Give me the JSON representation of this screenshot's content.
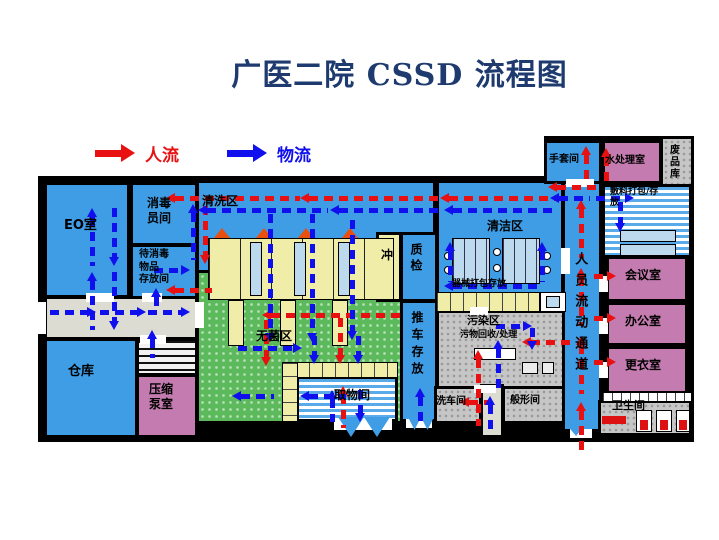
{
  "title": "广医二院 CSSD 流程图",
  "legend": {
    "people_label": "人流",
    "material_label": "物流"
  },
  "colors": {
    "red": "#e81010",
    "blue_arrow": "#1010ee",
    "title": "#1e3a6e",
    "blue": "#3f9de6",
    "green": "#5cba5c",
    "yellow": "#f0eda8",
    "pink": "#c47cb0",
    "gray": "#c6c6c6",
    "lgray": "#dcdcd2",
    "white": "#ffffff",
    "table_blue": "#bcd9ee",
    "wall": "#000000"
  },
  "rooms": [
    {
      "id": "eo",
      "x": 44,
      "y": 182,
      "w": 86,
      "h": 116,
      "f": "blue"
    },
    {
      "id": "xiaodu-yuanjian",
      "x": 130,
      "y": 182,
      "w": 68,
      "h": 64,
      "f": "blue"
    },
    {
      "id": "daixiaodu-cunfang",
      "x": 130,
      "y": 244,
      "w": 68,
      "h": 56,
      "f": "blue"
    },
    {
      "id": "corridor-left",
      "x": 44,
      "y": 296,
      "w": 154,
      "h": 44,
      "f": "lgray"
    },
    {
      "id": "cangku",
      "x": 44,
      "y": 338,
      "w": 94,
      "h": 100,
      "f": "blue"
    },
    {
      "id": "stairs",
      "x": 136,
      "y": 338,
      "w": 62,
      "h": 38,
      "f": "white",
      "p": "hatch"
    },
    {
      "id": "yasuo-bengshi",
      "x": 136,
      "y": 374,
      "w": 62,
      "h": 64,
      "f": "pink"
    },
    {
      "id": "qingxiqu",
      "x": 196,
      "y": 180,
      "w": 240,
      "h": 124,
      "f": "blue"
    },
    {
      "id": "wujunqu",
      "x": 196,
      "y": 270,
      "w": 240,
      "h": 154,
      "f": "green",
      "p": "dots"
    },
    {
      "id": "chong",
      "x": 376,
      "y": 232,
      "w": 26,
      "h": 70,
      "f": "yellow"
    },
    {
      "id": "zhijian",
      "x": 400,
      "y": 232,
      "w": 38,
      "h": 70,
      "f": "blue"
    },
    {
      "id": "tuiche-cunfang",
      "x": 400,
      "y": 300,
      "w": 38,
      "h": 122,
      "f": "blue"
    },
    {
      "id": "quwujian",
      "x": 296,
      "y": 376,
      "w": 102,
      "h": 46,
      "f": "white",
      "p": "stripes"
    },
    {
      "id": "qingjiequ",
      "x": 436,
      "y": 180,
      "w": 128,
      "h": 122,
      "f": "blue"
    },
    {
      "id": "wuranqu",
      "x": 436,
      "y": 310,
      "w": 130,
      "h": 80,
      "f": "gray",
      "p": "gdots"
    },
    {
      "id": "xichejian",
      "x": 434,
      "y": 386,
      "w": 48,
      "h": 38,
      "f": "gray",
      "p": "gdots"
    },
    {
      "id": "bottom-corridor",
      "x": 480,
      "y": 384,
      "w": 24,
      "h": 54,
      "f": "lgray"
    },
    {
      "id": "banxingjian",
      "x": 502,
      "y": 386,
      "w": 64,
      "h": 38,
      "f": "gray",
      "p": "gdots"
    },
    {
      "id": "renyuan-corridor",
      "x": 562,
      "y": 180,
      "w": 40,
      "h": 252,
      "f": "blue"
    },
    {
      "id": "shoutaojian",
      "x": 544,
      "y": 140,
      "w": 58,
      "h": 44,
      "f": "blue"
    },
    {
      "id": "shuichulishi",
      "x": 602,
      "y": 140,
      "w": 60,
      "h": 44,
      "f": "pink"
    },
    {
      "id": "feipinku",
      "x": 660,
      "y": 136,
      "w": 34,
      "h": 62,
      "f": "gray",
      "p": "gdots"
    },
    {
      "id": "fuliao-dabao",
      "x": 602,
      "y": 184,
      "w": 90,
      "h": 74,
      "f": "white",
      "p": "stripes"
    },
    {
      "id": "huiyishi",
      "x": 606,
      "y": 256,
      "w": 82,
      "h": 46,
      "f": "pink"
    },
    {
      "id": "bangongshi",
      "x": 606,
      "y": 302,
      "w": 82,
      "h": 44,
      "f": "pink"
    },
    {
      "id": "gengyishi",
      "x": 606,
      "y": 346,
      "w": 82,
      "h": 48,
      "f": "pink"
    },
    {
      "id": "weishengjian",
      "x": 598,
      "y": 400,
      "w": 94,
      "h": 36,
      "f": "gray",
      "p": "gdots"
    }
  ],
  "labels": [
    {
      "id": "eo",
      "t": "EO室",
      "x": 64,
      "y": 218,
      "fs": 13
    },
    {
      "id": "xiaodu-yuanjian",
      "t": "消毒\n员间",
      "x": 147,
      "y": 196,
      "fs": 12
    },
    {
      "id": "daixiaodu",
      "t": "待消毒\n物品\n存放间",
      "x": 139,
      "y": 249,
      "fs": 10
    },
    {
      "id": "cangku",
      "t": "仓库",
      "x": 68,
      "y": 364,
      "fs": 13
    },
    {
      "id": "yasuo",
      "t": "压缩\n泵室",
      "x": 149,
      "y": 382,
      "fs": 12
    },
    {
      "id": "qingxiqu",
      "t": "清洗区",
      "x": 202,
      "y": 194,
      "fs": 12
    },
    {
      "id": "wujunqu",
      "t": "无菌区",
      "x": 256,
      "y": 329,
      "fs": 12
    },
    {
      "id": "chong",
      "t": "冲",
      "x": 381,
      "y": 248,
      "fs": 12
    },
    {
      "id": "zhijian",
      "t": "质检",
      "x": 408,
      "y": 243,
      "fs": 12,
      "v": 1,
      "ls": 4
    },
    {
      "id": "tuiche",
      "t": "推车存放",
      "x": 409,
      "y": 311,
      "fs": 12,
      "v": 1,
      "ls": 5
    },
    {
      "id": "quwujian",
      "t": "取物间",
      "x": 334,
      "y": 388,
      "fs": 12
    },
    {
      "id": "qingjiequ",
      "t": "清洁区",
      "x": 487,
      "y": 219,
      "fs": 12
    },
    {
      "id": "qixie",
      "t": "器械打包存放",
      "x": 452,
      "y": 279,
      "fs": 9
    },
    {
      "id": "wuranqu",
      "t": "污染区",
      "x": 467,
      "y": 314,
      "fs": 11
    },
    {
      "id": "wuwu",
      "t": "污物回收/处理",
      "x": 460,
      "y": 330,
      "fs": 9
    },
    {
      "id": "xichejian",
      "t": "洗车间",
      "x": 436,
      "y": 396,
      "fs": 10
    },
    {
      "id": "banxingjian",
      "t": "般形间",
      "x": 510,
      "y": 395,
      "fs": 10
    },
    {
      "id": "renyuan",
      "t": "人员流动通道",
      "x": 571,
      "y": 252,
      "fs": 13,
      "v": 1,
      "ls": 8
    },
    {
      "id": "shoutao",
      "t": "手套间",
      "x": 549,
      "y": 154,
      "fs": 10
    },
    {
      "id": "shuichuli",
      "t": "水处理室",
      "x": 605,
      "y": 155,
      "fs": 10
    },
    {
      "id": "feipinku",
      "t": "废品库",
      "x": 666,
      "y": 144,
      "fs": 10,
      "v": 1,
      "ls": 2
    },
    {
      "id": "fuliao",
      "t": "敷料打包/存\n放",
      "x": 610,
      "y": 187,
      "fs": 9
    },
    {
      "id": "huiyishi",
      "t": "会议室",
      "x": 625,
      "y": 268,
      "fs": 12
    },
    {
      "id": "bangongshi",
      "t": "办公室",
      "x": 625,
      "y": 314,
      "fs": 12
    },
    {
      "id": "gengyishi",
      "t": "更衣室",
      "x": 625,
      "y": 358,
      "fs": 12
    },
    {
      "id": "weishengjian",
      "t": "卫生间",
      "x": 612,
      "y": 399,
      "fs": 11
    }
  ],
  "fixtures": [
    {
      "t": "rect",
      "x": 208,
      "y": 238,
      "w": 186,
      "h": 62,
      "f": "yellow",
      "b": 1,
      "p": "cells30"
    },
    {
      "t": "rect",
      "x": 250,
      "y": 242,
      "w": 12,
      "h": 54,
      "f": "table_blue",
      "b": 1
    },
    {
      "t": "rect",
      "x": 294,
      "y": 242,
      "w": 12,
      "h": 54,
      "f": "table_blue",
      "b": 1
    },
    {
      "t": "rect",
      "x": 338,
      "y": 242,
      "w": 12,
      "h": 54,
      "f": "table_blue",
      "b": 1
    },
    {
      "t": "tri",
      "dir": "u",
      "x": 214,
      "y": 228,
      "w": 16,
      "h": 10,
      "f": "#e8500f"
    },
    {
      "t": "tri",
      "dir": "u",
      "x": 256,
      "y": 228,
      "w": 16,
      "h": 10,
      "f": "#e8500f"
    },
    {
      "t": "tri",
      "dir": "u",
      "x": 298,
      "y": 228,
      "w": 16,
      "h": 10,
      "f": "#e8500f"
    },
    {
      "t": "tri",
      "dir": "u",
      "x": 342,
      "y": 228,
      "w": 16,
      "h": 10,
      "f": "#e8500f"
    },
    {
      "t": "rect",
      "x": 228,
      "y": 300,
      "w": 16,
      "h": 46,
      "f": "yellow",
      "b": 1
    },
    {
      "t": "rect",
      "x": 280,
      "y": 300,
      "w": 16,
      "h": 46,
      "f": "yellow",
      "b": 1
    },
    {
      "t": "rect",
      "x": 332,
      "y": 300,
      "w": 16,
      "h": 46,
      "f": "yellow",
      "b": 1
    },
    {
      "t": "rect",
      "x": 282,
      "y": 362,
      "w": 116,
      "h": 16,
      "f": "yellow",
      "b": 1,
      "p": "cells12"
    },
    {
      "t": "rect",
      "x": 282,
      "y": 362,
      "w": 16,
      "h": 60,
      "f": "yellow",
      "b": 1,
      "p": "cellsH"
    },
    {
      "t": "rect",
      "x": 452,
      "y": 238,
      "w": 38,
      "h": 46,
      "f": "table_blue",
      "b": 1,
      "p": "cells10"
    },
    {
      "t": "rect",
      "x": 502,
      "y": 238,
      "w": 38,
      "h": 46,
      "f": "table_blue",
      "b": 1,
      "p": "cells10"
    },
    {
      "t": "circ",
      "x": 444,
      "y": 252,
      "w": 8,
      "h": 8
    },
    {
      "t": "circ",
      "x": 444,
      "y": 266,
      "w": 8,
      "h": 8
    },
    {
      "t": "circ",
      "x": 493,
      "y": 248,
      "w": 8,
      "h": 8
    },
    {
      "t": "circ",
      "x": 493,
      "y": 264,
      "w": 8,
      "h": 8
    },
    {
      "t": "circ",
      "x": 543,
      "y": 252,
      "w": 8,
      "h": 8
    },
    {
      "t": "circ",
      "x": 543,
      "y": 266,
      "w": 8,
      "h": 8
    },
    {
      "t": "rect",
      "x": 436,
      "y": 292,
      "w": 104,
      "h": 20,
      "f": "yellow",
      "b": 1,
      "p": "cells12"
    },
    {
      "t": "rect",
      "x": 540,
      "y": 292,
      "w": 26,
      "h": 20,
      "f": "white",
      "b": 1
    },
    {
      "t": "rect",
      "x": 546,
      "y": 296,
      "w": 14,
      "h": 12,
      "f": "table_blue",
      "b": 1
    },
    {
      "t": "rect",
      "x": 474,
      "y": 348,
      "w": 42,
      "h": 12,
      "f": "white",
      "b": 1
    },
    {
      "t": "rect",
      "x": 522,
      "y": 362,
      "w": 16,
      "h": 12,
      "f": "#ececec",
      "b": 1
    },
    {
      "t": "rect",
      "x": 542,
      "y": 362,
      "w": 12,
      "h": 12,
      "f": "#ececec",
      "b": 1
    },
    {
      "t": "rect",
      "x": 620,
      "y": 230,
      "w": 56,
      "h": 12,
      "f": "table_blue",
      "b": 1
    },
    {
      "t": "rect",
      "x": 620,
      "y": 244,
      "w": 56,
      "h": 12,
      "f": "table_blue",
      "b": 1
    },
    {
      "t": "rect",
      "x": 602,
      "y": 392,
      "w": 90,
      "h": 10,
      "f": "white",
      "b": 1,
      "p": "cells8"
    },
    {
      "t": "rect",
      "x": 636,
      "y": 410,
      "w": 16,
      "h": 22,
      "f": "white",
      "b": 1
    },
    {
      "t": "rect",
      "x": 656,
      "y": 410,
      "w": 16,
      "h": 22,
      "f": "white",
      "b": 1
    },
    {
      "t": "rect",
      "x": 676,
      "y": 410,
      "w": 14,
      "h": 22,
      "f": "white",
      "b": 1
    },
    {
      "t": "rect",
      "x": 640,
      "y": 420,
      "w": 8,
      "h": 10,
      "f": "#dd1111"
    },
    {
      "t": "rect",
      "x": 660,
      "y": 420,
      "w": 8,
      "h": 10,
      "f": "#dd1111"
    },
    {
      "t": "rect",
      "x": 679,
      "y": 420,
      "w": 8,
      "h": 10,
      "f": "#dd1111"
    },
    {
      "t": "rect",
      "x": 602,
      "y": 416,
      "w": 24,
      "h": 8,
      "f": "#dd1111"
    },
    {
      "t": "rect",
      "x": 86,
      "y": 293,
      "w": 28,
      "h": 9,
      "f": "white"
    },
    {
      "t": "rect",
      "x": 142,
      "y": 293,
      "w": 20,
      "h": 9,
      "f": "white"
    },
    {
      "t": "rect",
      "x": 140,
      "y": 335,
      "w": 26,
      "h": 9,
      "f": "white"
    },
    {
      "t": "rect",
      "x": 195,
      "y": 302,
      "w": 9,
      "h": 26,
      "f": "white"
    },
    {
      "t": "rect",
      "x": 334,
      "y": 419,
      "w": 58,
      "h": 11,
      "f": "white"
    },
    {
      "t": "rect",
      "x": 406,
      "y": 419,
      "w": 26,
      "h": 9,
      "f": "white"
    },
    {
      "t": "rect",
      "x": 474,
      "y": 385,
      "w": 22,
      "h": 8,
      "f": "white"
    },
    {
      "t": "rect",
      "x": 561,
      "y": 248,
      "w": 9,
      "h": 26,
      "f": "white"
    },
    {
      "t": "rect",
      "x": 599,
      "y": 276,
      "w": 9,
      "h": 16,
      "f": "white"
    },
    {
      "t": "rect",
      "x": 599,
      "y": 318,
      "w": 9,
      "h": 16,
      "f": "white"
    },
    {
      "t": "rect",
      "x": 599,
      "y": 362,
      "w": 9,
      "h": 16,
      "f": "white"
    },
    {
      "t": "rect",
      "x": 566,
      "y": 179,
      "w": 28,
      "h": 8,
      "f": "white"
    },
    {
      "t": "rect",
      "x": 470,
      "y": 307,
      "w": 18,
      "h": 8,
      "f": "white"
    },
    {
      "t": "rect",
      "x": 38,
      "y": 302,
      "w": 8,
      "h": 32,
      "f": "white"
    },
    {
      "t": "rect",
      "x": 570,
      "y": 429,
      "w": 22,
      "h": 9,
      "f": "white"
    },
    {
      "t": "tri",
      "dir": "d",
      "x": 338,
      "y": 417,
      "w": 26,
      "h": 20,
      "f": "blue"
    },
    {
      "t": "tri",
      "dir": "d",
      "x": 364,
      "y": 417,
      "w": 26,
      "h": 20,
      "f": "blue"
    },
    {
      "t": "tri",
      "dir": "d",
      "x": 408,
      "y": 417,
      "w": 13,
      "h": 13,
      "f": "blue"
    },
    {
      "t": "tri",
      "dir": "d",
      "x": 421,
      "y": 417,
      "w": 13,
      "h": 13,
      "f": "blue"
    },
    {
      "t": "tri",
      "dir": "d",
      "x": 566,
      "y": 424,
      "w": 20,
      "h": 12,
      "f": "blue"
    }
  ],
  "arrows": [
    {
      "c": "r",
      "d": "l",
      "x": 166,
      "y": 196,
      "l": 134
    },
    {
      "c": "r",
      "d": "l",
      "x": 300,
      "y": 196,
      "l": 140
    },
    {
      "c": "r",
      "d": "l",
      "x": 440,
      "y": 196,
      "l": 118
    },
    {
      "c": "r",
      "d": "l",
      "x": 548,
      "y": 185,
      "l": 50
    },
    {
      "c": "r",
      "d": "u",
      "x": 584,
      "y": 146,
      "l": 38
    },
    {
      "c": "r",
      "d": "u",
      "x": 604,
      "y": 148,
      "l": 34
    },
    {
      "c": "r",
      "d": "d",
      "x": 203,
      "y": 206,
      "l": 58
    },
    {
      "c": "r",
      "d": "l",
      "x": 166,
      "y": 288,
      "l": 46
    },
    {
      "c": "r",
      "d": "u",
      "x": 579,
      "y": 200,
      "l": 58
    },
    {
      "c": "r",
      "d": "u",
      "x": 579,
      "y": 268,
      "l": 58
    },
    {
      "c": "r",
      "d": "u",
      "x": 579,
      "y": 336,
      "l": 58
    },
    {
      "c": "r",
      "d": "u",
      "x": 579,
      "y": 402,
      "l": 52
    },
    {
      "c": "r",
      "d": "r",
      "x": 594,
      "y": 274,
      "l": 22
    },
    {
      "c": "r",
      "d": "r",
      "x": 594,
      "y": 316,
      "l": 22
    },
    {
      "c": "r",
      "d": "r",
      "x": 594,
      "y": 360,
      "l": 22
    },
    {
      "c": "r",
      "d": "l",
      "x": 522,
      "y": 340,
      "l": 48
    },
    {
      "c": "r",
      "d": "u",
      "x": 476,
      "y": 350,
      "l": 76
    },
    {
      "c": "r",
      "d": "l",
      "x": 460,
      "y": 400,
      "l": 28
    },
    {
      "c": "r",
      "d": "l",
      "x": 262,
      "y": 313,
      "l": 138
    },
    {
      "c": "r",
      "d": "d",
      "x": 338,
      "y": 318,
      "l": 46
    },
    {
      "c": "r",
      "d": "d",
      "x": 264,
      "y": 320,
      "l": 46
    },
    {
      "c": "r",
      "d": "u",
      "x": 341,
      "y": 386,
      "l": 42
    },
    {
      "c": "b",
      "d": "l",
      "x": 198,
      "y": 208,
      "l": 130
    },
    {
      "c": "b",
      "d": "l",
      "x": 330,
      "y": 208,
      "l": 112
    },
    {
      "c": "b",
      "d": "l",
      "x": 444,
      "y": 208,
      "l": 112
    },
    {
      "c": "b",
      "d": "r",
      "x": 596,
      "y": 196,
      "l": 38
    },
    {
      "c": "b",
      "d": "d",
      "x": 618,
      "y": 202,
      "l": 30
    },
    {
      "c": "b",
      "d": "u",
      "x": 191,
      "y": 204,
      "l": 56
    },
    {
      "c": "b",
      "d": "u",
      "x": 90,
      "y": 208,
      "l": 58
    },
    {
      "c": "b",
      "d": "u",
      "x": 90,
      "y": 272,
      "l": 58
    },
    {
      "c": "b",
      "d": "d",
      "x": 112,
      "y": 208,
      "l": 58
    },
    {
      "c": "b",
      "d": "d",
      "x": 112,
      "y": 272,
      "l": 58
    },
    {
      "c": "b",
      "d": "r",
      "x": 154,
      "y": 268,
      "l": 36
    },
    {
      "c": "b",
      "d": "r",
      "x": 50,
      "y": 310,
      "l": 46
    },
    {
      "c": "b",
      "d": "r",
      "x": 100,
      "y": 310,
      "l": 46
    },
    {
      "c": "b",
      "d": "r",
      "x": 148,
      "y": 310,
      "l": 42
    },
    {
      "c": "b",
      "d": "u",
      "x": 154,
      "y": 288,
      "l": 24
    },
    {
      "c": "b",
      "d": "u",
      "x": 150,
      "y": 330,
      "l": 28
    },
    {
      "c": "b",
      "d": "d",
      "x": 268,
      "y": 214,
      "l": 128
    },
    {
      "c": "b",
      "d": "d",
      "x": 310,
      "y": 214,
      "l": 128
    },
    {
      "c": "b",
      "d": "d",
      "x": 350,
      "y": 220,
      "l": 120
    },
    {
      "c": "b",
      "d": "l",
      "x": 444,
      "y": 284,
      "l": 96
    },
    {
      "c": "b",
      "d": "u",
      "x": 448,
      "y": 242,
      "l": 40
    },
    {
      "c": "b",
      "d": "u",
      "x": 540,
      "y": 242,
      "l": 40
    },
    {
      "c": "b",
      "d": "r",
      "x": 238,
      "y": 346,
      "l": 64
    },
    {
      "c": "b",
      "d": "d",
      "x": 312,
      "y": 336,
      "l": 28
    },
    {
      "c": "b",
      "d": "d",
      "x": 356,
      "y": 336,
      "l": 28
    },
    {
      "c": "b",
      "d": "l",
      "x": 232,
      "y": 394,
      "l": 42
    },
    {
      "c": "b",
      "d": "l",
      "x": 300,
      "y": 394,
      "l": 46
    },
    {
      "c": "b",
      "d": "u",
      "x": 330,
      "y": 390,
      "l": 32
    },
    {
      "c": "b",
      "d": "d",
      "x": 358,
      "y": 390,
      "l": 32
    },
    {
      "c": "b",
      "d": "r",
      "x": 496,
      "y": 324,
      "l": 36
    },
    {
      "c": "b",
      "d": "d",
      "x": 530,
      "y": 328,
      "l": 22
    },
    {
      "c": "b",
      "d": "u",
      "x": 496,
      "y": 340,
      "l": 52
    },
    {
      "c": "b",
      "d": "u",
      "x": 488,
      "y": 396,
      "l": 36
    },
    {
      "c": "b",
      "d": "u",
      "x": 418,
      "y": 388,
      "l": 34
    },
    {
      "c": "b",
      "d": "l",
      "x": 550,
      "y": 196,
      "l": 40
    }
  ]
}
